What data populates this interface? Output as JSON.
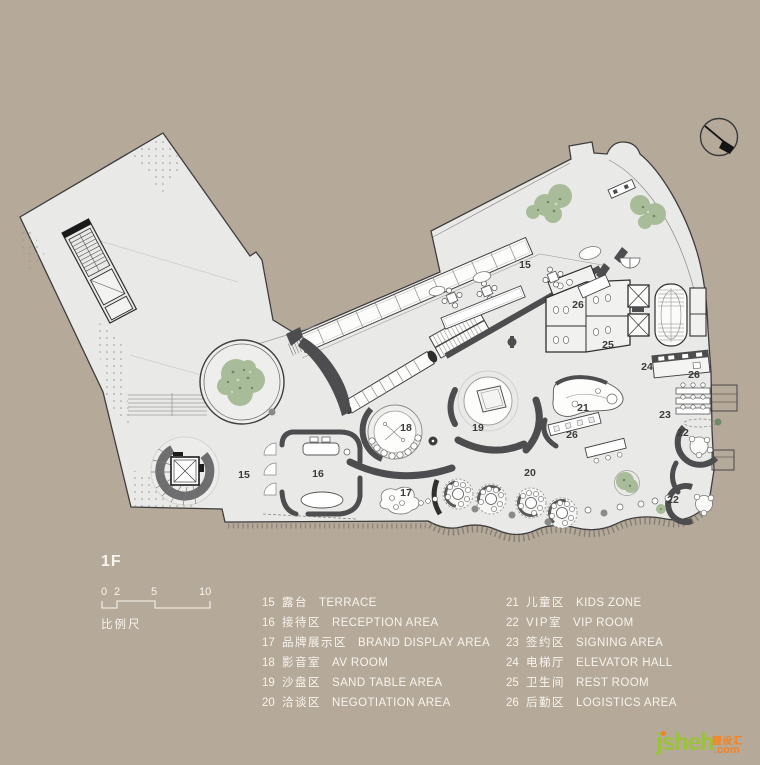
{
  "title": "1F",
  "scale_bar": {
    "ticks": [
      "0",
      "2",
      "5",
      "10"
    ],
    "label": "比例尺"
  },
  "legend": {
    "left": [
      {
        "num": "15",
        "zh": "露台",
        "en": "TERRACE"
      },
      {
        "num": "16",
        "zh": "接待区",
        "en": "RECEPTION AREA"
      },
      {
        "num": "17",
        "zh": "品牌展示区",
        "en": "BRAND DISPLAY AREA"
      },
      {
        "num": "18",
        "zh": "影音室",
        "en": "AV ROOM"
      },
      {
        "num": "19",
        "zh": "沙盘区",
        "en": "SAND TABLE AREA"
      },
      {
        "num": "20",
        "zh": "洽谈区",
        "en": "NEGOTIATION AREA"
      }
    ],
    "right": [
      {
        "num": "21",
        "zh": "儿童区",
        "en": "KIDS ZONE"
      },
      {
        "num": "22",
        "zh": "VIP室",
        "en": "VIP ROOM"
      },
      {
        "num": "23",
        "zh": "签约区",
        "en": "SIGNING AREA"
      },
      {
        "num": "24",
        "zh": "电梯厅",
        "en": "ELEVATOR HALL"
      },
      {
        "num": "25",
        "zh": "卫生间",
        "en": "REST ROOM"
      },
      {
        "num": "26",
        "zh": "后勤区",
        "en": "LOGISTICS AREA"
      }
    ]
  },
  "plan": {
    "labels": [
      {
        "text": "15"
      },
      {
        "text": "15"
      },
      {
        "text": "16"
      },
      {
        "text": "17"
      },
      {
        "text": "18"
      },
      {
        "text": "19"
      },
      {
        "text": "20"
      },
      {
        "text": "21"
      },
      {
        "text": "22"
      },
      {
        "text": "22"
      },
      {
        "text": "23"
      },
      {
        "text": "24"
      },
      {
        "text": "25"
      },
      {
        "text": "26"
      },
      {
        "text": "26"
      },
      {
        "text": "26"
      }
    ]
  },
  "icons": {
    "north_arrow": "north-arrow-icon"
  },
  "watermark": {
    "brand": "jsheh",
    "tld": ".com",
    "cn": "狸设汇"
  },
  "colors": {
    "background": "#b5a999",
    "floor": "#e9e9e7",
    "wall_dark": "#4d4d4f",
    "line": "#3e3e3e",
    "foliage": "#a9bc9a",
    "watermark_green": "#9cc13b",
    "watermark_orange": "#f58220",
    "text_light": "#f8f5ee"
  }
}
